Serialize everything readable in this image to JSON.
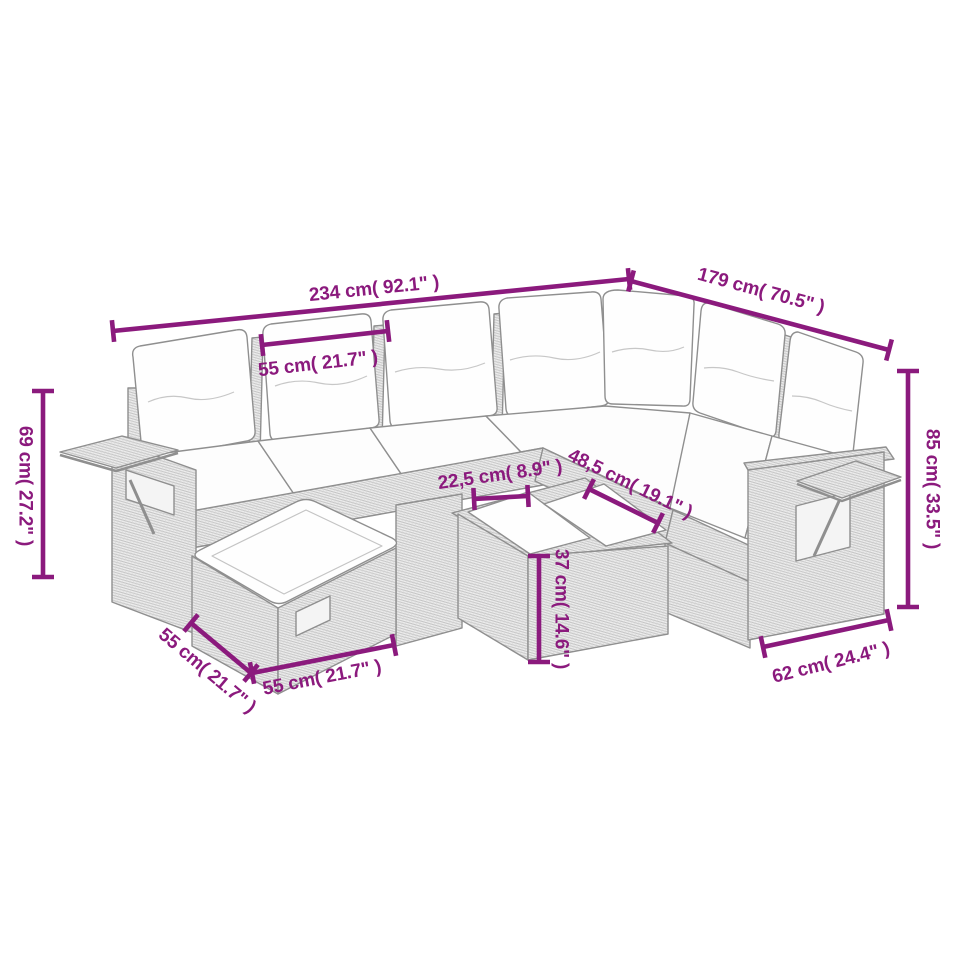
{
  "scene": {
    "description": "Line-art product dimension diagram of an 8-piece poly rattan garden corner sofa set with cushions, footstool, side trays and coffee table",
    "background_color": "#ffffff",
    "accent_color": "#8B1A7D",
    "lineart_color": "#8f8f8f"
  },
  "dimensions": {
    "total_width": "234 cm( 92.1\" )",
    "total_depth": "179 cm( 70.5\" )",
    "backrest_cushion_width": "55 cm( 21.7\" )",
    "left_section_height": "69 cm( 27.2\" )",
    "total_height": "85 cm( 33.5\" )",
    "front_rail_width": "22,5 cm( 8.9\" )",
    "corner_section_width": "48,5 cm( 19.1\" )",
    "coffee_table_height": "37 cm( 14.6\" )",
    "footstool_depth": "55 cm( 21.7\" )",
    "footstool_width": "55 cm( 21.7\" )",
    "armrest_section_width": "62 cm( 24.4\" )"
  }
}
